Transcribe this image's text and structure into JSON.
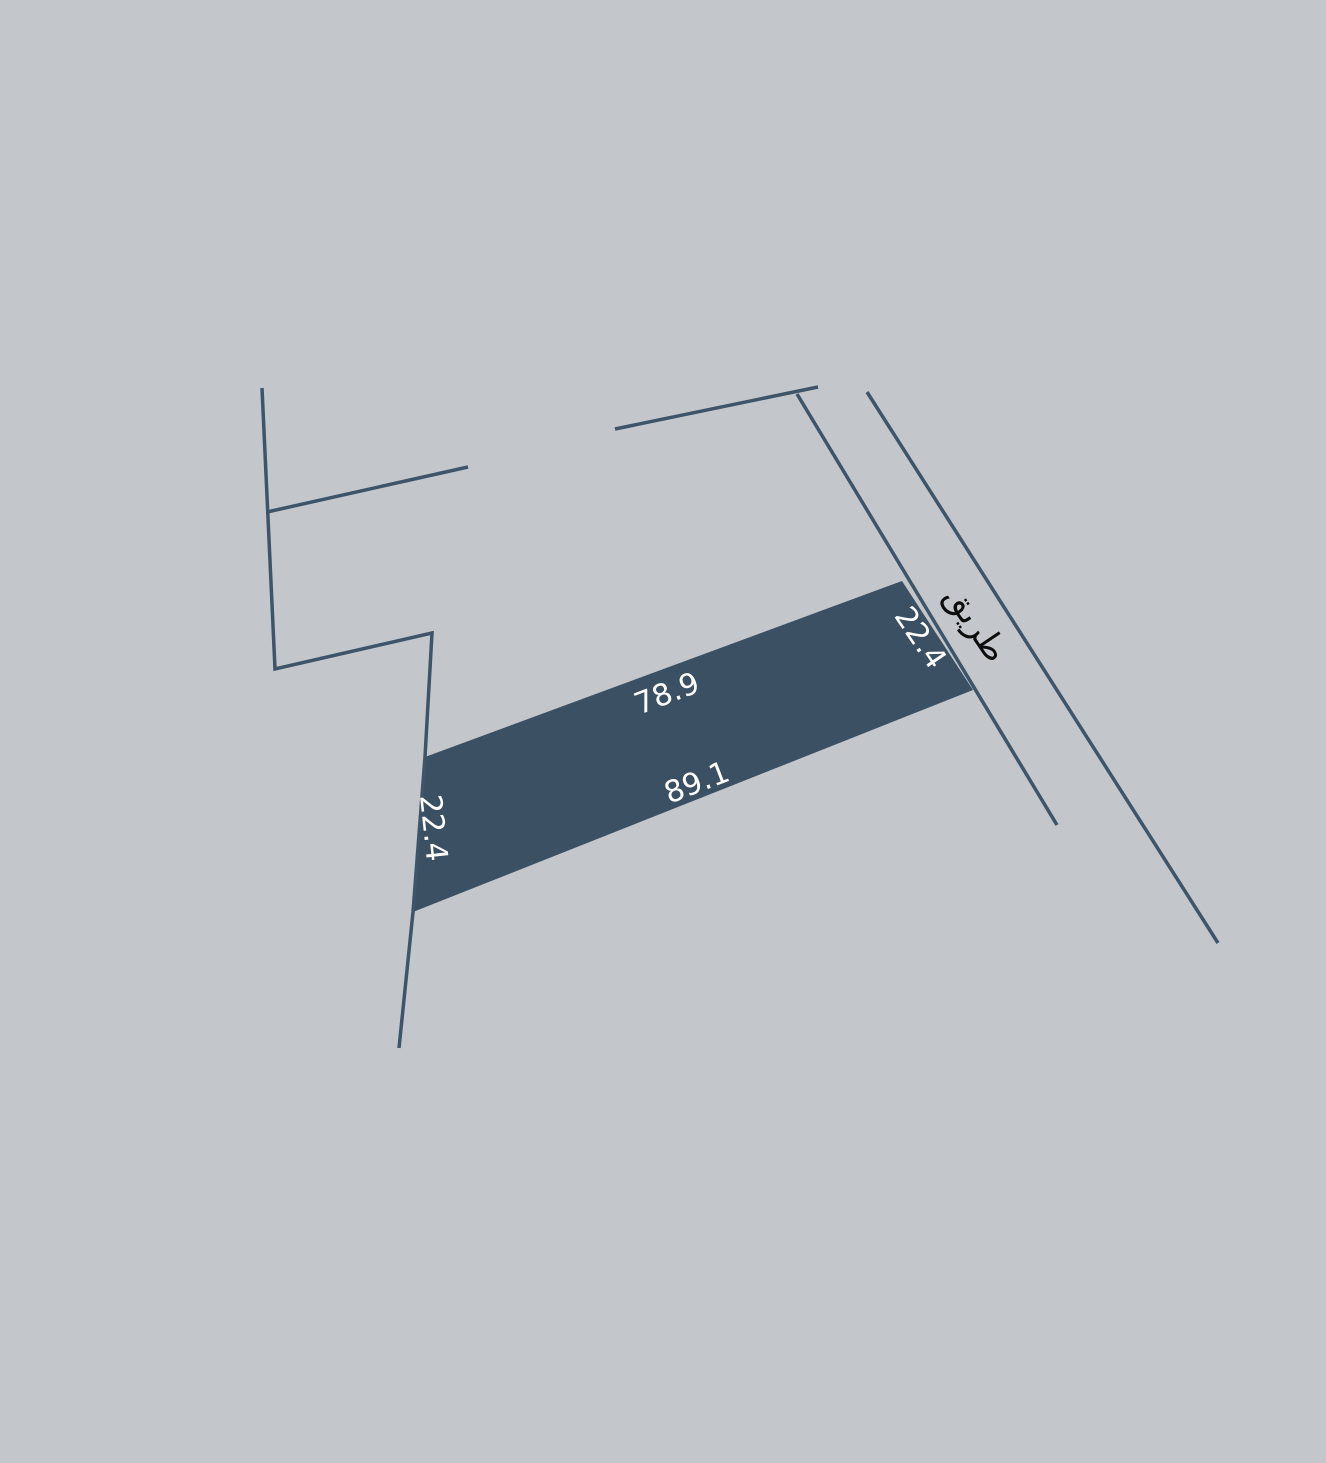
{
  "canvas": {
    "width": 1326,
    "height": 1463,
    "background_color": "#c3c7cc"
  },
  "colors": {
    "boundary_line": "#3e5468",
    "parcel_fill": "#3c5064",
    "parcel_label_color": "#ffffff",
    "road_label_color": "#0d0d0d"
  },
  "parcel": {
    "points": [
      [
        425,
        757
      ],
      [
        902,
        581
      ],
      [
        973,
        690
      ],
      [
        413,
        912
      ]
    ],
    "edge_labels": [
      {
        "id": "parcel-length-top",
        "text": "78.9",
        "x": 667,
        "y": 694,
        "rotation": -21,
        "font_size": 30
      },
      {
        "id": "parcel-length-bottom",
        "text": "89.1",
        "x": 697,
        "y": 783,
        "rotation": -21,
        "font_size": 30
      },
      {
        "id": "parcel-width-left",
        "text": "22.4",
        "x": 433,
        "y": 828,
        "rotation": 84,
        "font_size": 30
      },
      {
        "id": "parcel-width-right",
        "text": "22.4",
        "x": 920,
        "y": 638,
        "rotation": 56,
        "font_size": 30
      }
    ]
  },
  "road": {
    "label": {
      "id": "road-name",
      "text": "طريق",
      "x": 976,
      "y": 624,
      "rotation": 56,
      "font_size": 34
    }
  },
  "boundaries": [
    {
      "id": "boundary-west-polyline",
      "points": [
        [
          262,
          388
        ],
        [
          275,
          669
        ],
        [
          432,
          633
        ],
        [
          425,
          757
        ],
        [
          413,
          912
        ],
        [
          399,
          1048
        ]
      ]
    },
    {
      "id": "boundary-branch-line",
      "points": [
        [
          267,
          512
        ],
        [
          468,
          467
        ]
      ]
    },
    {
      "id": "boundary-north-line",
      "points": [
        [
          615,
          429
        ],
        [
          818,
          387
        ]
      ]
    },
    {
      "id": "road-edge-left-line",
      "points": [
        [
          797,
          394
        ],
        [
          1057,
          825
        ]
      ]
    },
    {
      "id": "road-edge-right-line",
      "points": [
        [
          867,
          392
        ],
        [
          1218,
          943
        ]
      ]
    }
  ],
  "line_width": 3.5
}
